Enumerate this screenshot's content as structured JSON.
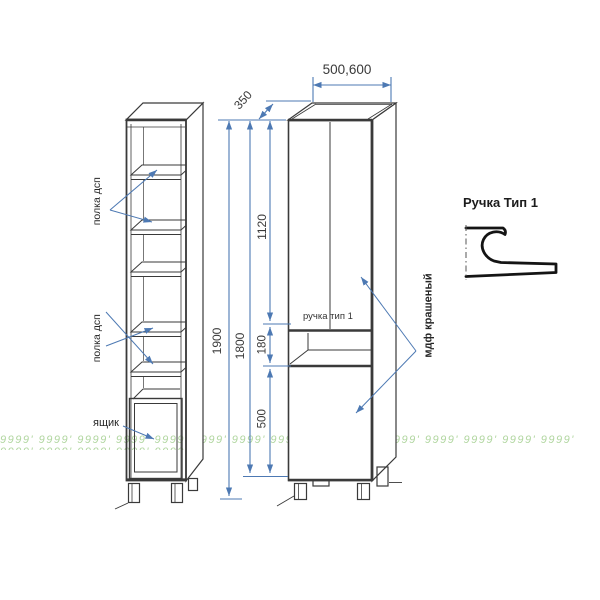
{
  "colors": {
    "dimension_line": "#4d79b3",
    "drawing_line": "#3a3a3a",
    "watermark_green": "#a9d296"
  },
  "dimensions": {
    "top_width": "500,600",
    "depth": "350",
    "overall_height": "1900",
    "body_height": "1800",
    "upper_door_height": "1120",
    "niche_height": "180",
    "lower_door_height": "500"
  },
  "side_view": {
    "shelf_label_upper": "полка дсп",
    "shelf_label_lower": "полка дсп",
    "drawer_label": "ящик"
  },
  "front_view": {
    "handle_label": "ручка тип 1",
    "material_label": "мдф крашеный"
  },
  "handle_detail": {
    "title": "Ручка Тип 1"
  },
  "watermark": {
    "text": "9999' 9999' 9999' 9999' 9999' 9999' 9999' 9999' 9999' 9999' 9999' 9999' 9999' 9999' 9999' 9999' 9999' 9999' 9999' 9999'"
  }
}
